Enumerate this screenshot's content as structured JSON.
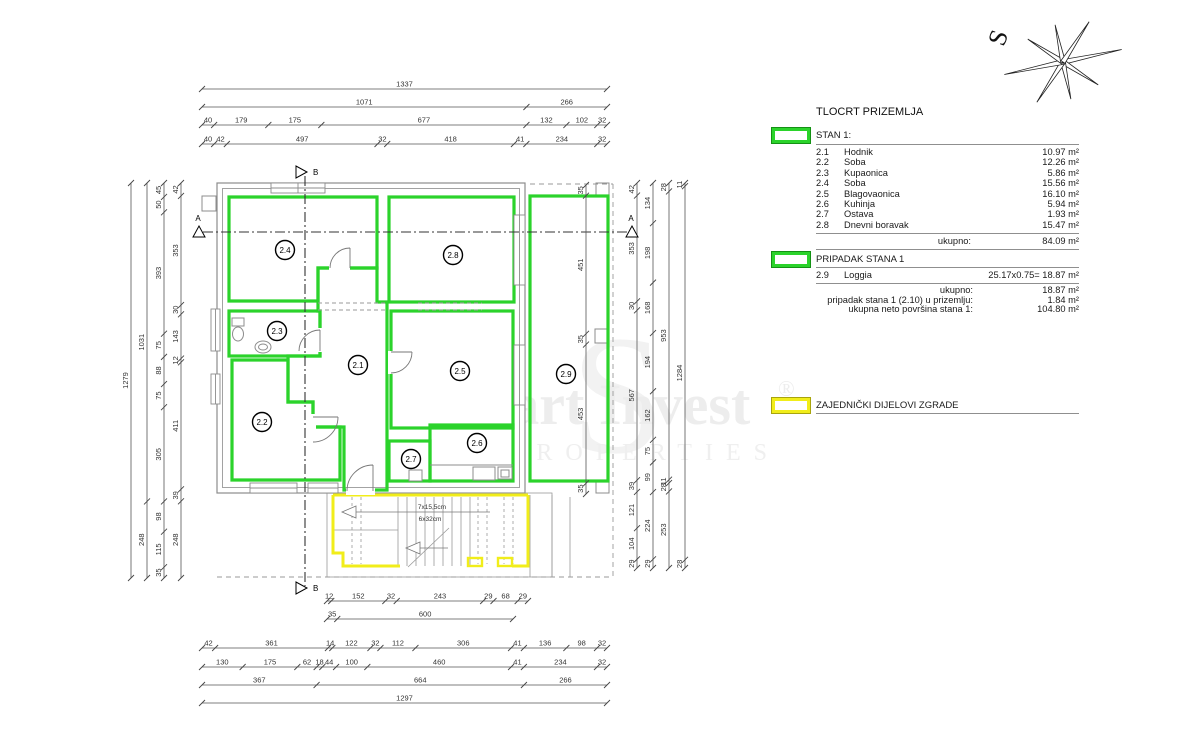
{
  "legend": {
    "title": "TLOCRT PRIZEMLJA",
    "stan1": {
      "header": "STAN 1:",
      "rows": [
        {
          "code": "2.1",
          "name": "Hodnik",
          "area": "10.97 m²"
        },
        {
          "code": "2.2",
          "name": "Soba",
          "area": "12.26 m²"
        },
        {
          "code": "2.3",
          "name": "Kupaonica",
          "area": "5.86 m²"
        },
        {
          "code": "2.4",
          "name": "Soba",
          "area": "15.56 m²"
        },
        {
          "code": "2.5",
          "name": "Blagovaonica",
          "area": "16.10 m²"
        },
        {
          "code": "2.6",
          "name": "Kuhinja",
          "area": "5.94 m²"
        },
        {
          "code": "2.7",
          "name": "Ostava",
          "area": "1.93 m²"
        },
        {
          "code": "2.8",
          "name": "Dnevni boravak",
          "area": "15.47 m²"
        }
      ],
      "total": {
        "label": "ukupno:",
        "value": "84.09 m²"
      }
    },
    "pripadak": {
      "header": "PRIPADAK STANA 1",
      "row": {
        "code": "2.9",
        "name": "Loggia",
        "calc": "25.17x0.75= 18.87 m²"
      },
      "summary": [
        {
          "label": "ukupno:",
          "value": "18.87 m²"
        },
        {
          "label": "pripadak stana 1 (2.10) u prizemlju:",
          "value": "1.84 m²"
        },
        {
          "label": "ukupna neto površina stana 1:",
          "value": "104.80 m²"
        }
      ]
    },
    "zajednicki": {
      "header": "ZAJEDNIČKI DIJELOVI ZGRADE"
    }
  },
  "compass": {
    "label": "S"
  },
  "watermark": {
    "main": "Smart Invest",
    "reg": "®",
    "sub": "PROPERTIES",
    "big": "S"
  },
  "plan": {
    "rooms": [
      {
        "id": "2.1",
        "x": 358,
        "y": 365
      },
      {
        "id": "2.2",
        "x": 262,
        "y": 422
      },
      {
        "id": "2.3",
        "x": 277,
        "y": 331
      },
      {
        "id": "2.4",
        "x": 285,
        "y": 250
      },
      {
        "id": "2.5",
        "x": 460,
        "y": 371
      },
      {
        "id": "2.6",
        "x": 477,
        "y": 443
      },
      {
        "id": "2.7",
        "x": 411,
        "y": 459
      },
      {
        "id": "2.8",
        "x": 453,
        "y": 255
      },
      {
        "id": "2.9",
        "x": 566,
        "y": 374
      }
    ],
    "stair_note": {
      "line1": "7x15,5cm",
      "line2": "6x32cm"
    },
    "section_markers": [
      {
        "label": "B",
        "x": 305,
        "y": 172,
        "dir": "right"
      },
      {
        "label": "B",
        "x": 305,
        "y": 588,
        "dir": "right"
      },
      {
        "label": "A",
        "x": 199,
        "y": 233,
        "dir": "up"
      },
      {
        "label": "A",
        "x": 632,
        "y": 233,
        "dir": "up"
      }
    ],
    "dim_chains": [
      {
        "o": "h",
        "p": 89,
        "a": 202,
        "b": 607,
        "v": [
          1337
        ]
      },
      {
        "o": "h",
        "p": 107,
        "a": 202,
        "b": 607,
        "v": [
          1071,
          266
        ]
      },
      {
        "o": "h",
        "p": 125,
        "a": 202,
        "b": 607,
        "v": [
          40,
          179,
          175,
          677,
          132,
          102,
          32
        ]
      },
      {
        "o": "h",
        "p": 144,
        "a": 202,
        "b": 607,
        "v": [
          40,
          42,
          497,
          32,
          418,
          41,
          234,
          32
        ]
      },
      {
        "o": "v",
        "p": 131,
        "a": 183,
        "b": 578,
        "v": [
          1279
        ]
      },
      {
        "o": "v",
        "p": 147,
        "a": 183,
        "b": 578,
        "v": [
          1031,
          248
        ]
      },
      {
        "o": "v",
        "p": 164,
        "a": 183,
        "b": 578,
        "v": [
          45,
          50,
          393,
          75,
          88,
          75,
          305,
          98,
          115,
          35
        ]
      },
      {
        "o": "v",
        "p": 181,
        "a": 183,
        "b": 578,
        "v": [
          42,
          353,
          30,
          143,
          12,
          411,
          39,
          248
        ]
      },
      {
        "o": "v",
        "p": 637,
        "a": 183,
        "b": 568,
        "v": [
          42,
          353,
          30,
          567,
          39,
          121,
          104,
          29
        ]
      },
      {
        "o": "v",
        "p": 653,
        "a": 183,
        "b": 568,
        "v": [
          134,
          198,
          168,
          194,
          162,
          75,
          99,
          224,
          29
        ]
      },
      {
        "o": "v",
        "p": 669,
        "a": 183,
        "b": 568,
        "v": [
          28,
          953,
          11,
          28,
          253
        ]
      },
      {
        "o": "v",
        "p": 685,
        "a": 183,
        "b": 568,
        "v": [
          11,
          1284,
          28
        ]
      },
      {
        "o": "v",
        "p": 586,
        "a": 185,
        "b": 494,
        "v": [
          35,
          451,
          35,
          453,
          35
        ]
      },
      {
        "o": "h",
        "p": 601,
        "a": 327,
        "b": 528,
        "v": [
          12,
          152,
          32,
          243,
          29,
          68,
          29
        ]
      },
      {
        "o": "h",
        "p": 619,
        "a": 327,
        "b": 513,
        "v": [
          35,
          600
        ]
      },
      {
        "o": "h",
        "p": 648,
        "a": 202,
        "b": 607,
        "v": [
          42,
          361,
          14,
          122,
          32,
          112,
          306,
          41,
          136,
          98,
          32
        ]
      },
      {
        "o": "h",
        "p": 667,
        "a": 202,
        "b": 607,
        "v": [
          130,
          175,
          62,
          18,
          44,
          100,
          460,
          41,
          234,
          32
        ]
      },
      {
        "o": "h",
        "p": 685,
        "a": 202,
        "b": 607,
        "v": [
          367,
          664,
          266
        ]
      },
      {
        "o": "h",
        "p": 703,
        "a": 202,
        "b": 607,
        "v": [
          1297
        ]
      }
    ]
  },
  "colors": {
    "green": "#2bd32b",
    "green_dark": "#149114",
    "yellow": "#f1ed1a",
    "wall": "#8c8c8c",
    "dim": "#444444",
    "watermark": "#ededed"
  }
}
